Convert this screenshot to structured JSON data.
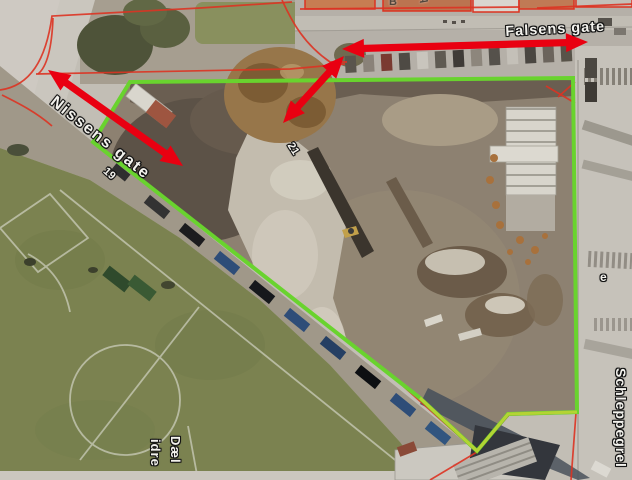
{
  "map": {
    "labels": {
      "falsens_gate": {
        "text": "Falsens gate"
      },
      "nissens_gate": {
        "text": "Nissens gate"
      },
      "schleppegrels_gate": {
        "text": "Schleppegrel"
      },
      "bottom_label_line1": {
        "text": "Dæl"
      },
      "bottom_label_line2": {
        "text": "idre"
      },
      "house_number_19": {
        "text": "19"
      },
      "house_number_21": {
        "text": "21"
      },
      "partial_glyph_b": {
        "text": "B"
      },
      "partial_glyph_a": {
        "text": "A"
      },
      "partial_glyph_e": {
        "text": "e"
      }
    },
    "annotations": {
      "boundary_color": "#69d32e",
      "boundary_bottom_color": "#bdd335",
      "arrow_color": "#e90011",
      "red_line_color": "#dd3322",
      "site_boundary_points": "130,82 573,78 577,412 508,414 477,451 420,398 93,142",
      "boundary_bottom_points": "420,398 477,451 508,414 577,412",
      "arrows": [
        {
          "name": "falsens-gate-arrow",
          "x1": 342,
          "y1": 49,
          "x2": 588,
          "y2": 42
        },
        {
          "name": "site-diagonal-arrow",
          "x1": 283,
          "y1": 123,
          "x2": 344,
          "y2": 56
        },
        {
          "name": "nissens-gate-arrow",
          "x1": 48,
          "y1": 70,
          "x2": 183,
          "y2": 166
        }
      ],
      "red_paths": [
        "M 0,90 C 30,86 46,60 52,16 L 200,8 L 292,2",
        "M 36,74 L 290,69 L 345,64",
        "M 282,0 C 292,22 304,44 330,62 L 347,62",
        "M 38,74 C 48,66 52,44 53,18",
        "M 2,95 C 18,103 36,112 52,126",
        "M 546,86 L 575,103",
        "M 575,82 L 558,97",
        "M 300,9 L 520,7",
        "M 537,8 L 632,4",
        "M 403,386 L 477,452 L 430,480",
        "M 477,452 L 509,415 L 576,413 L 571,480"
      ]
    }
  }
}
